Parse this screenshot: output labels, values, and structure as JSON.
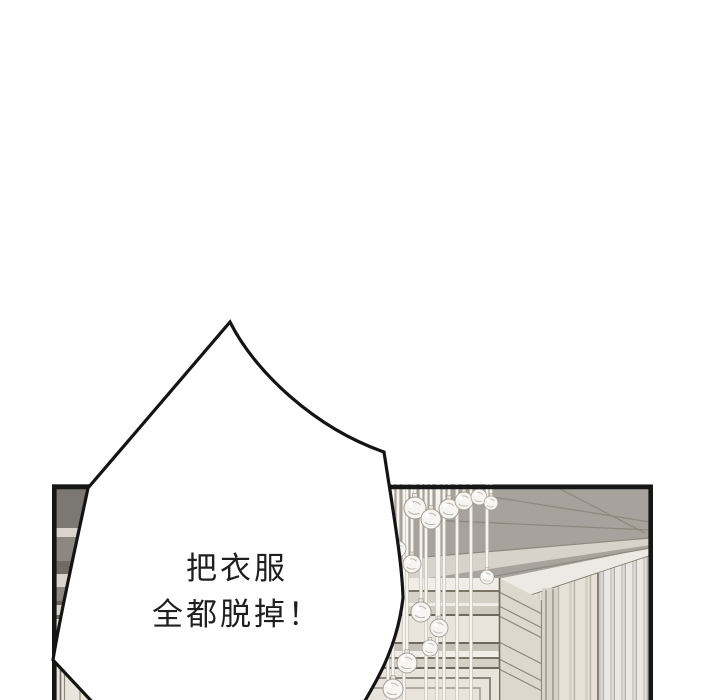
{
  "panel": {
    "speech_bubble": {
      "text_lines": [
        "把衣服",
        "全都脱掉！"
      ]
    }
  },
  "theme": {
    "page_background": "#ffffff",
    "panel_border": "#161616",
    "bubble_fill": "#ffffff",
    "bubble_stroke": "#141414",
    "text_color": "#1f1f1f",
    "ceiling": "#a7a39c",
    "beam_light": "#d7d3cb",
    "cornice": "#edeae4",
    "gray_strip": "#a8a49d",
    "wall_dark_band": "#7b7873",
    "wall_mid_band": "#8b8882",
    "wall_deep_band": "#6f6c67",
    "wall_light_band": "#d9d5cc",
    "base_cream": "#e9e5dc",
    "curtain_left": "#e7e1d7",
    "curtain_right": "#e9e8e4",
    "molding_line": "#6e695f",
    "fascia": "#e9e5dd",
    "wainscot": "#e8e4db",
    "string_core": "#f6f4ef",
    "ball_fill": "#f7f5f1",
    "ball_stroke": "#a29d94"
  }
}
